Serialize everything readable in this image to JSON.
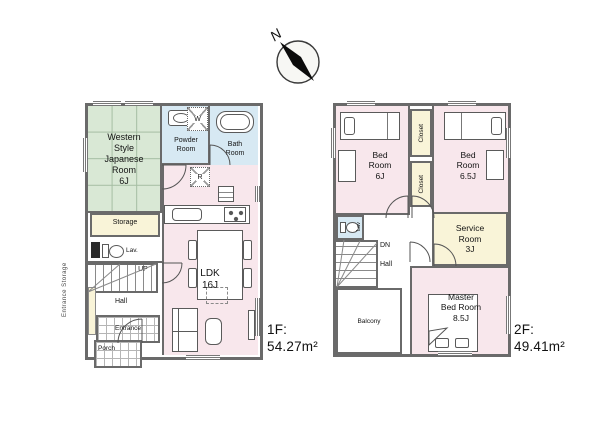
{
  "compass": {
    "north_label": "N"
  },
  "floor1": {
    "floor_label": "1F:",
    "area": "54.27m²",
    "rooms": {
      "japanese_room": "Western\nStyle\nJapanese\nRoom\n6J",
      "storage": "Storage",
      "lavatory": "Lav.",
      "up": "UP",
      "hall": "Hall",
      "entrance": "Entrance",
      "entrance_storage": "Entrance Storage",
      "porch": "Porch",
      "powder_room": "Powder\nRoom",
      "bath_room": "Bath\nRoom",
      "ldk": "LDK\n16J"
    },
    "icons": {
      "washing_machine": "W",
      "refrigerator": "R"
    }
  },
  "floor2": {
    "floor_label": "2F:",
    "area": "49.41m²",
    "rooms": {
      "bedroom_6j": "Bed\nRoom\n6J",
      "closet_a": "Closet",
      "closet_b": "Closet",
      "bedroom_6_5j": "Bed\nRoom\n6.5J",
      "lavatory": "Lav",
      "down": "DN",
      "hall": "Hall",
      "service_room": "Service\nRoom\n3J",
      "master_bedroom": "Master\nBed Room\n8.5J",
      "balcony": "Balcony"
    }
  },
  "colors": {
    "wall": "#6a6a6a",
    "room_pink": "#f8e7ec",
    "tatami_green": "#d9e8d5",
    "wet_area_blue": "#d7e9f3",
    "closet_cream": "#f9f4d8"
  }
}
